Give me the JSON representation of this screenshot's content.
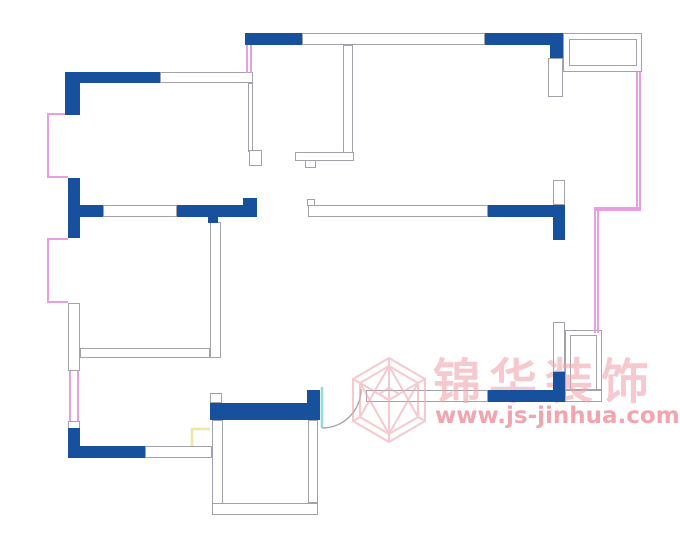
{
  "canvas": {
    "width": 680,
    "height": 535,
    "background": "#FFFFFF"
  },
  "watermark": {
    "logo_icon": "jinhua-hexagon-cube-logo",
    "brand_text": "锦华装饰",
    "url_text": "www.js-jinhua.com"
  },
  "colors": {
    "wall_fill": "#17519E",
    "wall_line": "#A2A2AA",
    "window_line": "#E79FE2",
    "door_leaf": "#9AD8D2",
    "door_arc": "#A2A2AA",
    "cabinet_line": "#F0E6A8",
    "watermark": "#F0A6AD",
    "watermark_strong": "#EE8F9B"
  },
  "plan": {
    "blue_walls": [
      {
        "n": "wall-topleft-room-top",
        "x": 65,
        "y": 72,
        "w": 95,
        "h": 11
      },
      {
        "n": "wall-topleft-room-corner",
        "x": 65,
        "y": 72,
        "w": 15,
        "h": 43
      },
      {
        "n": "wall-left-mid",
        "x": 68,
        "y": 178,
        "w": 12,
        "h": 60
      },
      {
        "n": "wall-mid-left-stub",
        "x": 80,
        "y": 205,
        "w": 23,
        "h": 12
      },
      {
        "n": "wall-mid-left-seg",
        "x": 177,
        "y": 205,
        "w": 80,
        "h": 12
      },
      {
        "n": "wall-mid-notch",
        "x": 208,
        "y": 217,
        "w": 10,
        "h": 6
      },
      {
        "n": "wall-mid-tab",
        "x": 243,
        "y": 198,
        "w": 14,
        "h": 7
      },
      {
        "n": "wall-left-bottom-corner",
        "x": 68,
        "y": 428,
        "w": 12,
        "h": 30
      },
      {
        "n": "wall-bottom-left",
        "x": 68,
        "y": 446,
        "w": 77,
        "h": 12
      },
      {
        "n": "wall-top-a",
        "x": 245,
        "y": 33,
        "w": 57,
        "h": 12
      },
      {
        "n": "wall-top-b",
        "x": 485,
        "y": 33,
        "w": 78,
        "h": 12
      },
      {
        "n": "wall-top-right-corner",
        "x": 550,
        "y": 33,
        "w": 13,
        "h": 25
      },
      {
        "n": "wall-mid-right",
        "x": 488,
        "y": 205,
        "w": 77,
        "h": 12
      },
      {
        "n": "wall-right-upper",
        "x": 553,
        "y": 205,
        "w": 12,
        "h": 35
      },
      {
        "n": "wall-right-lower",
        "x": 553,
        "y": 372,
        "w": 12,
        "h": 30
      },
      {
        "n": "wall-bottom-mid",
        "x": 488,
        "y": 390,
        "w": 77,
        "h": 12
      },
      {
        "n": "wall-room-top-bar",
        "x": 210,
        "y": 403,
        "w": 98,
        "h": 17
      },
      {
        "n": "wall-room-top-right-block",
        "x": 307,
        "y": 390,
        "w": 13,
        "h": 30
      }
    ],
    "hollow_walls": [
      {
        "n": "wall-top-hollow",
        "x": 302,
        "y": 33,
        "w": 183,
        "h": 12
      },
      {
        "n": "wall-topleft-room-top-hollow",
        "x": 160,
        "y": 72,
        "w": 93,
        "h": 11
      },
      {
        "n": "partition-topleft-room-right",
        "x": 248,
        "y": 83,
        "w": 5,
        "h": 69
      },
      {
        "n": "doorstop-a",
        "x": 249,
        "y": 150,
        "w": 13,
        "h": 16
      },
      {
        "n": "partition-entry-right",
        "x": 343,
        "y": 45,
        "w": 10,
        "h": 108
      },
      {
        "n": "doorstop-b-bar",
        "x": 295,
        "y": 152,
        "w": 59,
        "h": 9
      },
      {
        "n": "doorstop-b-notch",
        "x": 305,
        "y": 160,
        "w": 11,
        "h": 8
      },
      {
        "n": "wall-mid-hollow",
        "x": 103,
        "y": 205,
        "w": 74,
        "h": 12
      },
      {
        "n": "wall-mid-right-hollow",
        "x": 308,
        "y": 205,
        "w": 180,
        "h": 12
      },
      {
        "n": "wall-mid-right-cap",
        "x": 307,
        "y": 199,
        "w": 8,
        "h": 7
      },
      {
        "n": "wall-left-hollow",
        "x": 68,
        "y": 303,
        "w": 12,
        "h": 68
      },
      {
        "n": "wall-left-bit",
        "x": 68,
        "y": 421,
        "w": 12,
        "h": 8
      },
      {
        "n": "wall-bottom-hollow",
        "x": 145,
        "y": 446,
        "w": 67,
        "h": 12
      },
      {
        "n": "wall-corridor",
        "x": 210,
        "y": 222,
        "w": 11,
        "h": 136
      },
      {
        "n": "wall-interior-left",
        "x": 80,
        "y": 348,
        "w": 130,
        "h": 10
      },
      {
        "n": "wall-right-stub-top",
        "x": 548,
        "y": 58,
        "w": 15,
        "h": 39
      },
      {
        "n": "wall-right-stub-mid",
        "x": 553,
        "y": 180,
        "w": 12,
        "h": 25
      },
      {
        "n": "wall-right-hollow",
        "x": 553,
        "y": 322,
        "w": 12,
        "h": 50
      },
      {
        "n": "wall-bottom-mid-hollow-left",
        "x": 366,
        "y": 390,
        "w": 122,
        "h": 12
      },
      {
        "n": "wall-bottom-mid-hollow-right",
        "x": 565,
        "y": 390,
        "w": 37,
        "h": 12
      },
      {
        "n": "wall-room-left",
        "x": 212,
        "y": 420,
        "w": 11,
        "h": 93
      },
      {
        "n": "wall-room-bottom",
        "x": 212,
        "y": 503,
        "w": 106,
        "h": 12
      },
      {
        "n": "wall-room-right",
        "x": 308,
        "y": 420,
        "w": 10,
        "h": 83
      },
      {
        "n": "wall-room-top-stub",
        "x": 210,
        "y": 393,
        "w": 12,
        "h": 10
      },
      {
        "n": "balcony-outer",
        "x": 563,
        "y": 33,
        "w": 79,
        "h": 39
      },
      {
        "n": "balcony-inner",
        "x": 569,
        "y": 39,
        "w": 68,
        "h": 27
      },
      {
        "n": "shaft-outer",
        "x": 565,
        "y": 330,
        "w": 37,
        "h": 60
      },
      {
        "n": "shaft-inner",
        "x": 570,
        "y": 335,
        "w": 27,
        "h": 55
      }
    ],
    "windows": [
      {
        "n": "window-bay-1",
        "x": 47,
        "y": 113,
        "w": 21,
        "h": 65,
        "sides": "ltb"
      },
      {
        "n": "window-bay-2",
        "x": 47,
        "y": 238,
        "w": 21,
        "h": 65,
        "sides": "ltb"
      },
      {
        "n": "window-left-flush",
        "x": 69,
        "y": 371,
        "w": 10,
        "h": 50,
        "sides": "lr"
      },
      {
        "n": "window-entry",
        "x": 246,
        "y": 45,
        "w": 6,
        "h": 28,
        "sides": "lr"
      },
      {
        "n": "window-right-upper",
        "x": 636,
        "y": 72,
        "w": 5,
        "h": 136,
        "sides": "lr"
      },
      {
        "n": "window-right-jog",
        "x": 594,
        "y": 207,
        "w": 47,
        "h": 4,
        "sides": "tb"
      },
      {
        "n": "window-right-lower",
        "x": 594,
        "y": 211,
        "w": 5,
        "h": 122,
        "sides": "lr"
      }
    ],
    "door": {
      "leaf": {
        "x": 322,
        "y1": 387,
        "y2": 428
      },
      "arc": "M 361 389 A 39 39 0 0 1 322 428"
    },
    "cabinet_polyline": "192,446 192,429 210,429"
  }
}
